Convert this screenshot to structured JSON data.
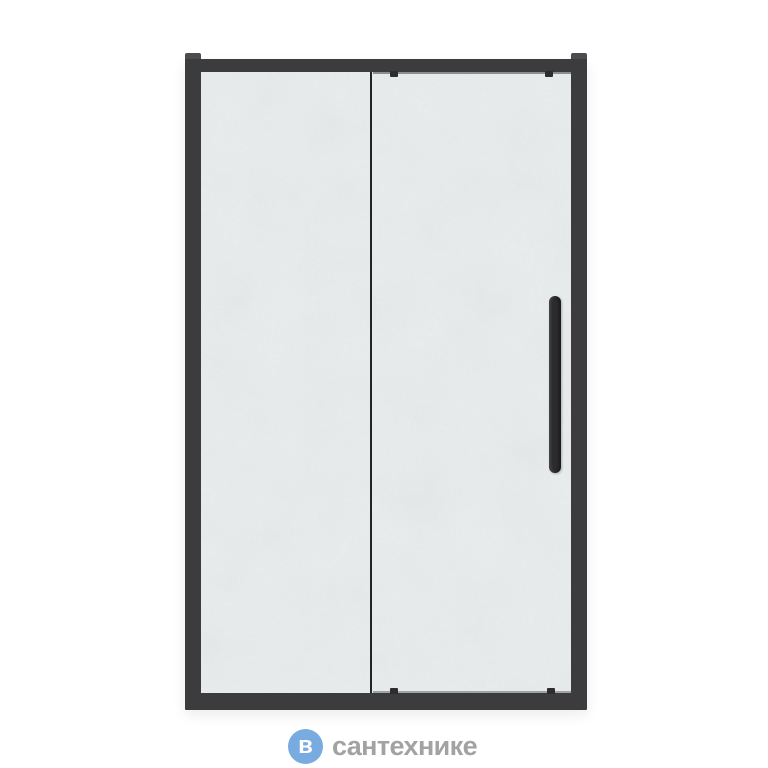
{
  "canvas": {
    "background": "#ffffff"
  },
  "product": {
    "name": "sliding-shower-door",
    "panels": [
      "fixed-glass-panel",
      "sliding-glass-panel"
    ],
    "colors": {
      "frame": "#3c3c3e",
      "frame_corner": "#4d4d4f",
      "glass": "#e9edee",
      "divider": "#242426",
      "roller": "#2d2d2f",
      "handle": "#2c2c2e"
    }
  },
  "watermark": {
    "icon_letter": "в",
    "icon_color": "#78abdf",
    "icon_letter_color": "#ffffff",
    "text": "сантехнике",
    "text_color": "#a2a2a2"
  }
}
